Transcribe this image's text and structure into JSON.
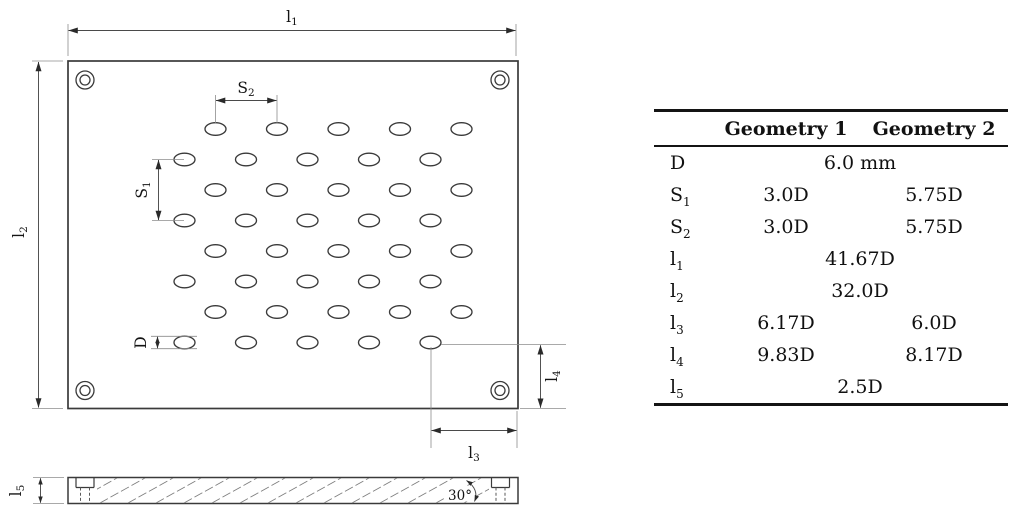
{
  "diagram": {
    "labels": {
      "l1": {
        "base": "l",
        "sub": "1"
      },
      "l2": {
        "base": "l",
        "sub": "2"
      },
      "l3": {
        "base": "l",
        "sub": "3"
      },
      "l4": {
        "base": "l",
        "sub": "4"
      },
      "l5": {
        "base": "l",
        "sub": "5"
      },
      "s1": {
        "base": "S",
        "sub": "1"
      },
      "s2": {
        "base": "S",
        "sub": "2"
      },
      "d": {
        "base": "D",
        "sub": ""
      },
      "angle": "30°"
    },
    "hole_pattern": {
      "rows": 8,
      "cols": 5,
      "first_row_y": 129,
      "row_spacing": 30.5,
      "odd_row_x_start": 215.5,
      "even_row_x_start": 184.5,
      "col_spacing": 61.5,
      "hole_rx": 10.5,
      "hole_ry": 6.3
    }
  },
  "table": {
    "headers": {
      "geometry1": "Geometry 1",
      "geometry2": "Geometry 2"
    },
    "rows": [
      {
        "label_base": "D",
        "label_sub": "",
        "span": "6.0 mm"
      },
      {
        "label_base": "S",
        "label_sub": "1",
        "g1": "3.0D",
        "g2": "5.75D"
      },
      {
        "label_base": "S",
        "label_sub": "2",
        "g1": "3.0D",
        "g2": "5.75D"
      },
      {
        "label_base": "l",
        "label_sub": "1",
        "span": "41.67D"
      },
      {
        "label_base": "l",
        "label_sub": "2",
        "span": "32.0D"
      },
      {
        "label_base": "l",
        "label_sub": "3",
        "g1": "6.17D",
        "g2": "6.0D"
      },
      {
        "label_base": "l",
        "label_sub": "4",
        "g1": "9.83D",
        "g2": "8.17D"
      },
      {
        "label_base": "l",
        "label_sub": "5",
        "span": "2.5D"
      }
    ]
  },
  "colors": {
    "line": "#3a3a3a",
    "thin_line": "#8c8c8c",
    "text": "#141414",
    "table_border": "#141414"
  }
}
